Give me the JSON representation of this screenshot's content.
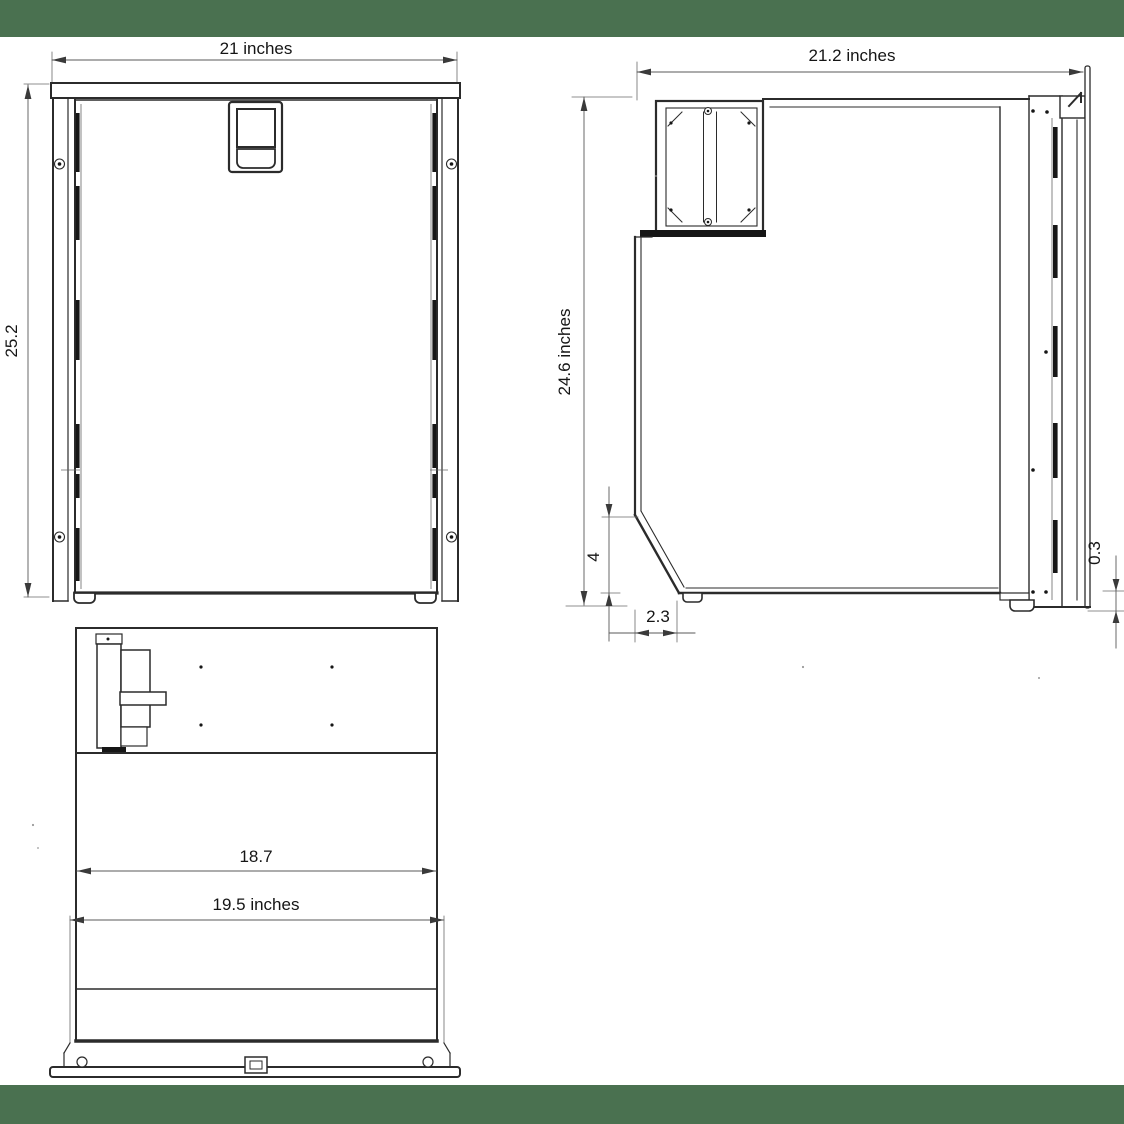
{
  "colors": {
    "band_green": "#4a7150",
    "line_dark": "#2b2b2b",
    "dimension_gray": "#5a5a5a",
    "background": "#ffffff"
  },
  "views": {
    "front": {
      "width_label": "21 inches",
      "height_label": "25.2"
    },
    "side": {
      "depth_label": "21.2 inches",
      "height_label": "24.6 inches",
      "back_chamfer_height_label": "4",
      "back_chamfer_depth_label": "2.3",
      "door_bottom_offset_label": "0.3"
    },
    "bottom": {
      "inner_width_label": "18.7",
      "flange_width_label": "19.5 inches"
    }
  }
}
